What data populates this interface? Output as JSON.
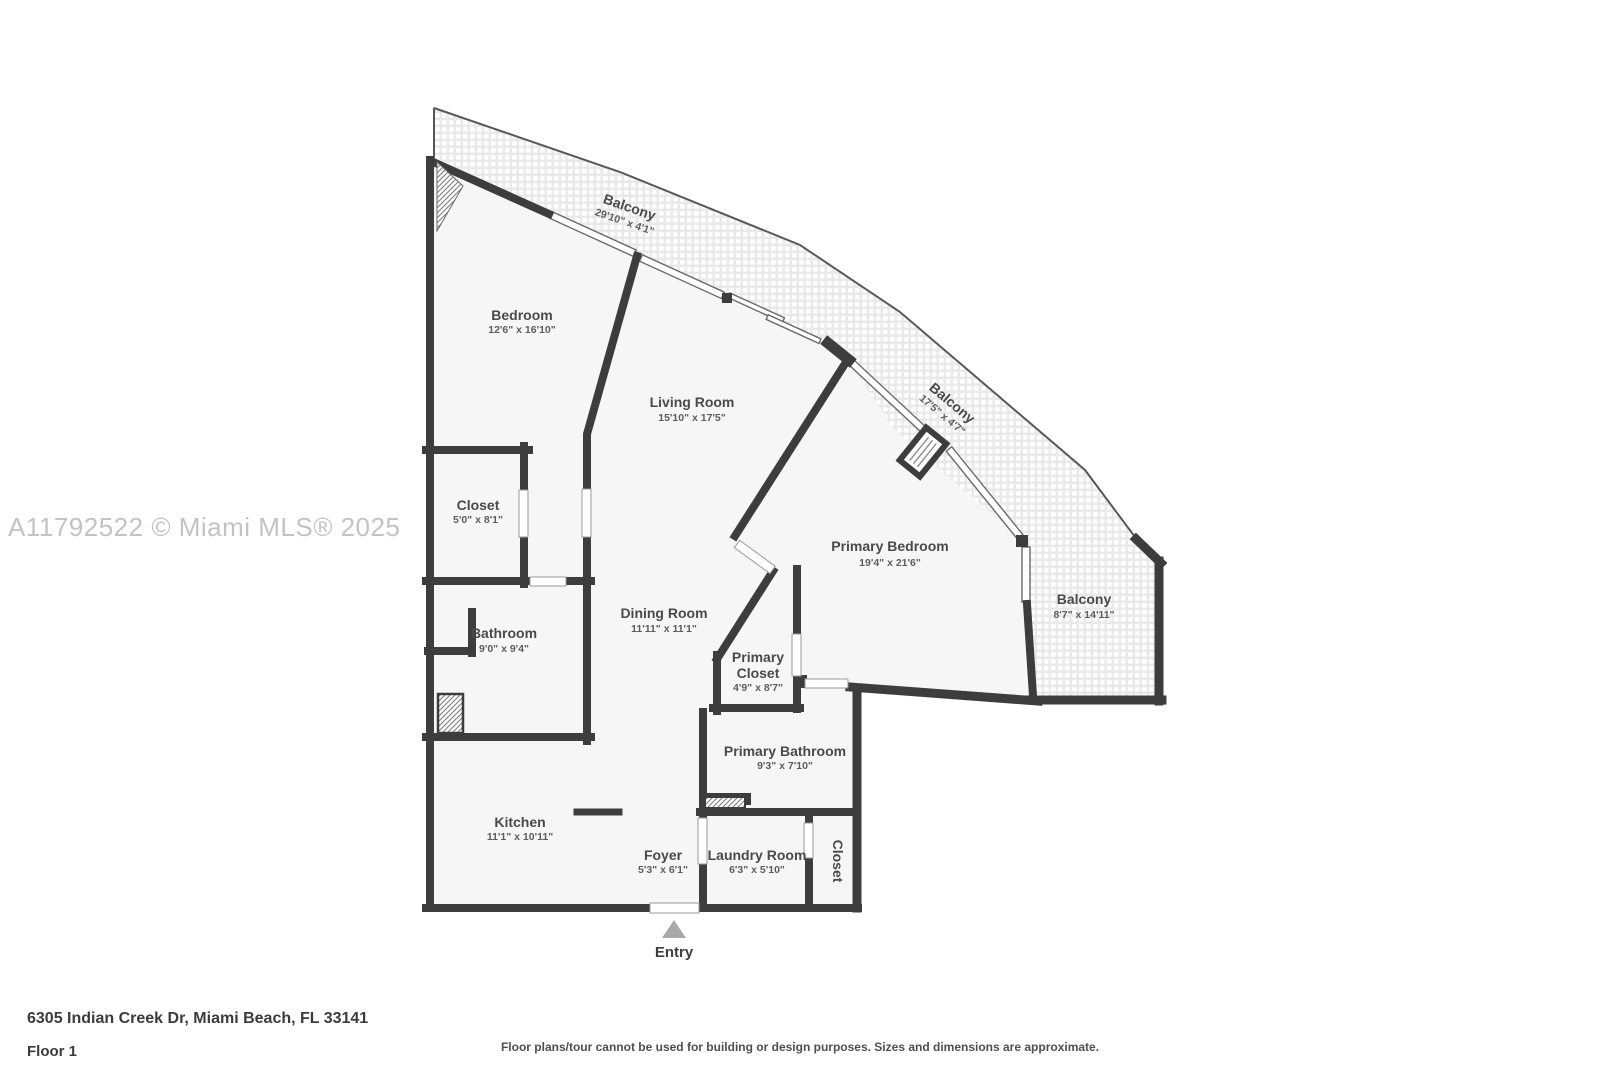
{
  "watermark": "A11792522 © Miami MLS® 2025",
  "footer": {
    "address": "6305 Indian Creek Dr, Miami Beach, FL 33141",
    "floor_label": "Floor 1",
    "disclaimer": "Floor plans/tour cannot be used for building or design purposes. Sizes and dimensions are approximate."
  },
  "plan": {
    "entry_label": "Entry",
    "rooms": [
      {
        "name": "Balcony",
        "dims": "29'10\" x 4'1\""
      },
      {
        "name": "Bedroom",
        "dims": "12'6\" x 16'10\""
      },
      {
        "name": "Living Room",
        "dims": "15'10\" x 17'5\""
      },
      {
        "name": "Balcony",
        "dims": "17'5\" x 4'7\""
      },
      {
        "name": "Closet",
        "dims": "5'0\" x 8'1\""
      },
      {
        "name": "Primary Bedroom",
        "dims": "19'4\" x 21'6\""
      },
      {
        "name": "Balcony",
        "dims": "8'7\" x 14'11\""
      },
      {
        "name": "Bathroom",
        "dims": "9'0\" x 9'4\""
      },
      {
        "name": "Dining Room",
        "dims": "11'11\" x 11'1\""
      },
      {
        "name": "Primary Closet",
        "name_lines": [
          "Primary",
          "Closet"
        ],
        "dims": "4'9\" x 8'7\""
      },
      {
        "name": "Primary Bathroom",
        "dims": "9'3\" x 7'10\""
      },
      {
        "name": "Kitchen",
        "dims": "11'1\" x 10'11\""
      },
      {
        "name": "Foyer",
        "dims": "5'3\" x 6'1\""
      },
      {
        "name": "Laundry Room",
        "dims": "6'3\" x 5'10\""
      },
      {
        "name": "Closet",
        "dims": ""
      }
    ]
  },
  "colors": {
    "wall": "#3d3d3d",
    "room_fill": "#f6f6f6",
    "balcony_tile_grout": "#e9e9e9",
    "label_text": "#4a4a4a",
    "watermark_text": "#c3c3c3",
    "entry_arrow": "#a8a8a8"
  }
}
